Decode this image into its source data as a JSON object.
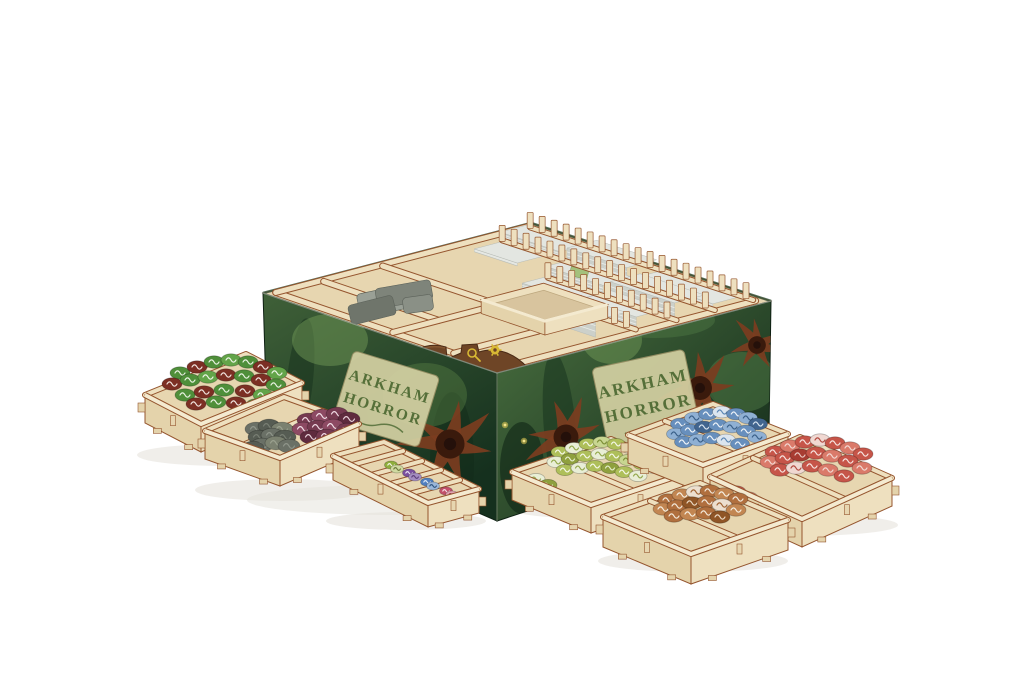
{
  "meta": {
    "alt": "Product photo of a wooden board game box organizer insert for Arkham Horror: an open game box with green tentacle cover art holding laser-cut plywood card racks full of cards, surrounded by seven small plywood trays filled with colored game tokens on a white background",
    "background": "#ffffff"
  },
  "logo": {
    "line1": "ARKHAM",
    "line2": "HORROR"
  },
  "colors": {
    "wood": "#eee0bf",
    "woodLight": "#f4ead0",
    "woodMid": "#e4d3ab",
    "woodFloor": "#e7d6b0",
    "woodShade": "#d6c096",
    "burn": "#95552e",
    "parchment": "#d3d0a2",
    "logoText": "#49662f",
    "tentacle": "#7c3d1f",
    "tentacleDark": "#3a1a0c",
    "card": "#ccd0ca",
    "cardLight": "#e3e6e1",
    "cardEdge": "#b8bcb6",
    "pieceBrown": "#6e4526",
    "pieceBrownDark": "#46260f",
    "glyphYellow": "#d8b934",
    "shadow": "#e6e3dc",
    "boxEdge": "#2c4a30"
  },
  "shadows": [
    [
      392,
      500,
      145,
      15
    ],
    [
      648,
      486,
      150,
      14
    ]
  ],
  "box": {
    "top": [
      [
        263,
        293
      ],
      [
        531,
        223
      ],
      [
        771,
        301
      ],
      [
        497,
        373
      ]
    ],
    "leftFace": "263,293 497,373 497,521 267,421",
    "rightFace": "497,373 771,301 769,432 497,521"
  },
  "innerWalls": [
    [
      0.03,
      0.02,
      0.03,
      0.97
    ],
    [
      0.03,
      0.97,
      0.97,
      0.97
    ],
    [
      0.03,
      0.02,
      0.97,
      0.02
    ],
    [
      0.2,
      0.03,
      0.2,
      0.52
    ],
    [
      0.42,
      0.03,
      0.42,
      0.52
    ],
    [
      0.03,
      0.52,
      0.42,
      0.52
    ],
    [
      0.03,
      0.78,
      0.34,
      0.78
    ]
  ],
  "cardRows": [
    {
      "a": 0.9,
      "segs": [
        [
          0.05,
          0.3,
          6
        ],
        [
          0.33,
          0.58,
          12
        ],
        [
          0.61,
          0.94,
          4
        ]
      ]
    },
    {
      "a": 0.76,
      "segs": [
        [
          0.1,
          0.28,
          3
        ],
        [
          0.4,
          0.64,
          9
        ],
        [
          0.67,
          0.94,
          15
        ]
      ]
    },
    {
      "a": 0.62,
      "segs": [
        [
          0.46,
          0.68,
          7
        ],
        [
          0.71,
          0.94,
          11
        ]
      ]
    },
    {
      "a": 0.48,
      "segs": [
        [
          0.6,
          0.93,
          17
        ]
      ]
    }
  ],
  "teethRows": [
    {
      "a": 0.97,
      "b1": 0.03,
      "b2": 0.96,
      "step": 0.05
    },
    {
      "a": 0.83,
      "b1": 0.07,
      "b2": 0.96,
      "step": 0.05
    },
    {
      "a": 0.69,
      "b1": 0.42,
      "b2": 0.96,
      "step": 0.05
    },
    {
      "a": 0.55,
      "b1": 0.56,
      "b2": 0.95,
      "step": 0.05
    }
  ],
  "greenCard": {
    "x": 579,
    "y": 273,
    "w": 18,
    "h": 9,
    "rot": 14,
    "fill": "#a4c17c"
  },
  "grayPieces": [
    [
      388,
      300,
      60,
      24,
      -12,
      "#9aa096"
    ],
    [
      404,
      294,
      56,
      20,
      -10,
      "#7e847a"
    ],
    [
      372,
      310,
      46,
      20,
      -14,
      "#6f756b"
    ],
    [
      418,
      304,
      30,
      16,
      -8,
      "#8a9086"
    ]
  ],
  "openBox": {
    "a1": 0.33,
    "b1": 0.55,
    "a2": 0.56,
    "b2": 0.82,
    "lift": 14
  },
  "frontPiece": {
    "shadow": "M402,394 C436,382 478,376 536,383 L536,396 L402,402 Z",
    "body": "M397,392 L397,371 C404,352 426,341 446,347 L447,359 L461,353 L462,345 L477,344 L479,352 C497,346 515,354 527,367 L541,385 L541,399 L469,408 L397,400 Z"
  },
  "blobs": [
    [
      "L",
      300,
      380,
      13,
      62,
      6,
      "#16301c",
      0.5
    ],
    [
      "L",
      352,
      442,
      15,
      68,
      4,
      "#1a3422",
      0.5
    ],
    [
      "L",
      452,
      462,
      22,
      70,
      0,
      "#122a19",
      0.45
    ],
    [
      "L",
      330,
      340,
      38,
      26,
      0,
      "#6f9756",
      0.5
    ],
    [
      "L",
      425,
      395,
      42,
      32,
      0,
      "#5d8547",
      0.4
    ],
    [
      "L",
      285,
      420,
      26,
      34,
      0,
      "#3f6439",
      0.5
    ],
    [
      "R",
      560,
      430,
      16,
      78,
      -5,
      "#14301c",
      0.5
    ],
    [
      "R",
      612,
      340,
      30,
      24,
      0,
      "#6f9756",
      0.5
    ],
    [
      "R",
      700,
      438,
      24,
      55,
      -4,
      "#173322",
      0.5
    ],
    [
      "R",
      742,
      382,
      36,
      30,
      0,
      "#548049",
      0.45
    ],
    [
      "R",
      522,
      468,
      22,
      46,
      0,
      "#0f2416",
      0.6
    ],
    [
      "R",
      655,
      320,
      60,
      18,
      0,
      "#4f7a45",
      0.45
    ]
  ],
  "starfish": [
    [
      "L",
      450,
      444,
      56,
      10
    ],
    [
      "L",
      302,
      434,
      34,
      40
    ],
    [
      "R",
      566,
      437,
      48,
      -20
    ],
    [
      "R",
      700,
      388,
      46,
      -5
    ],
    [
      "R",
      757,
      345,
      34,
      60
    ]
  ],
  "lights": [
    [
      524,
      441
    ],
    [
      536,
      469
    ],
    [
      316,
      446
    ],
    [
      505,
      425
    ]
  ],
  "trays": [
    {
      "name": "rune-tokens-tray",
      "rx": 10,
      "B": [
        246,
        354
      ],
      "R": [
        302,
        383
      ],
      "F": [
        201,
        424
      ],
      "L": [
        145,
        395
      ],
      "d": 28,
      "dividers": [],
      "palette": [
        "#4f8f3a",
        "#7c2f24",
        "#63a449",
        "#95402f"
      ],
      "marks": [
        "#e9f2e2",
        "#f0e3de",
        "#edf5e6",
        "#f0e3de"
      ],
      "tokens": [
        [
          180,
          373,
          0
        ],
        [
          197,
          367,
          1
        ],
        [
          214,
          362,
          0
        ],
        [
          231,
          360,
          2
        ],
        [
          248,
          362,
          0
        ],
        [
          263,
          367,
          1
        ],
        [
          277,
          373,
          2
        ],
        [
          172,
          384,
          1
        ],
        [
          190,
          380,
          0
        ],
        [
          208,
          377,
          2
        ],
        [
          226,
          375,
          1
        ],
        [
          244,
          376,
          0
        ],
        [
          261,
          380,
          1
        ],
        [
          276,
          385,
          0
        ],
        [
          185,
          395,
          0
        ],
        [
          204,
          392,
          1
        ],
        [
          224,
          390,
          0
        ],
        [
          245,
          391,
          1
        ],
        [
          263,
          395,
          2
        ],
        [
          279,
          398,
          1
        ],
        [
          196,
          404,
          1
        ],
        [
          216,
          402,
          0
        ],
        [
          236,
          403,
          1
        ],
        [
          256,
          405,
          0
        ]
      ],
      "shadow": [
        225,
        455,
        88,
        11
      ]
    },
    {
      "name": "coins-and-purple-tokens-tray",
      "rx": 11,
      "B": [
        284,
        397
      ],
      "R": [
        359,
        424
      ],
      "F": [
        280,
        458
      ],
      "L": [
        205,
        431
      ],
      "d": 28,
      "dividers": [
        [
          [
            245,
            444
          ],
          [
            323,
            411
          ]
        ]
      ],
      "palette": [
        "#6a7066",
        "#565c53",
        "#7b8170",
        "#763a50",
        "#8d4a63",
        "#5f2b3e"
      ],
      "marks": [
        "#8f958a",
        "#787e73",
        "#9aa08e",
        "#efd9e2",
        "#f2e0e8",
        "#e8d2da"
      ],
      "tokens": [
        [
          256,
          429,
          0
        ],
        [
          269,
          426,
          1
        ],
        [
          282,
          429,
          2
        ],
        [
          259,
          437,
          1
        ],
        [
          272,
          435,
          0
        ],
        [
          285,
          437,
          1
        ],
        [
          262,
          445,
          0
        ],
        [
          276,
          443,
          2
        ],
        [
          289,
          446,
          0
        ],
        [
          253,
          448,
          1
        ],
        [
          308,
          420,
          3
        ],
        [
          322,
          416,
          4
        ],
        [
          337,
          414,
          3
        ],
        [
          349,
          419,
          5
        ],
        [
          303,
          429,
          4
        ],
        [
          318,
          427,
          3
        ],
        [
          333,
          426,
          4
        ],
        [
          347,
          430,
          3
        ],
        [
          311,
          437,
          5
        ],
        [
          327,
          436,
          3
        ],
        [
          342,
          439,
          4
        ]
      ],
      "shadow": [
        283,
        490,
        88,
        11
      ]
    },
    {
      "name": "small-tokens-strip-tray",
      "rx": 6.5,
      "B": [
        384,
        442
      ],
      "R": [
        479,
        489
      ],
      "F": [
        428,
        503
      ],
      "L": [
        333,
        456
      ],
      "d": 24,
      "dividers": [
        [
          [
            403,
            451
          ],
          [
            352,
            465
          ]
        ],
        [
          [
            422,
            461
          ],
          [
            371,
            475
          ]
        ],
        [
          [
            441,
            470
          ],
          [
            390,
            484
          ]
        ],
        [
          [
            460,
            480
          ],
          [
            409,
            494
          ]
        ]
      ],
      "palette": [
        "#8fae3c",
        "#cfd9a0",
        "#7a4e9e",
        "#a48cc0",
        "#4f7ec0",
        "#9ab6d8",
        "#c2506a",
        "#e0a2b0"
      ],
      "marks": [
        "#f2f6e4",
        "#6b7a3a",
        "#e8e0f2",
        "#5d3f7a",
        "#dce8f4",
        "#2f5580",
        "#f4dde4",
        "#8f3248"
      ],
      "tokens": [
        [
          391,
          465,
          0
        ],
        [
          397,
          469,
          1
        ],
        [
          409,
          473,
          2
        ],
        [
          415,
          477,
          3
        ],
        [
          427,
          482,
          4
        ],
        [
          433,
          486,
          5
        ],
        [
          446,
          491,
          6
        ],
        [
          452,
          495,
          7
        ]
      ],
      "shadow": [
        406,
        521,
        80,
        9
      ]
    },
    {
      "name": "lime-tokens-tray",
      "rx": 9,
      "B": [
        611,
        439
      ],
      "R": [
        690,
        472
      ],
      "F": [
        591,
        505
      ],
      "L": [
        512,
        472
      ],
      "d": 28,
      "dividers": [
        [
          [
            555,
            458
          ],
          [
            634,
            491
          ]
        ]
      ],
      "palette": [
        "#aebf5a",
        "#e9eed6",
        "#8fa03e",
        "#c8d690"
      ],
      "marks": [
        "#f4f7e8",
        "#93a84c",
        "#e3ecc8",
        "#7c8f36"
      ],
      "tokens": [
        [
          560,
          452,
          0
        ],
        [
          574,
          448,
          1
        ],
        [
          588,
          444,
          0
        ],
        [
          602,
          442,
          3
        ],
        [
          616,
          444,
          0
        ],
        [
          630,
          448,
          1
        ],
        [
          644,
          452,
          0
        ],
        [
          656,
          457,
          2
        ],
        [
          556,
          462,
          1
        ],
        [
          570,
          459,
          2
        ],
        [
          585,
          456,
          0
        ],
        [
          600,
          454,
          1
        ],
        [
          614,
          456,
          0
        ],
        [
          628,
          460,
          3
        ],
        [
          642,
          464,
          0
        ],
        [
          654,
          468,
          1
        ],
        [
          565,
          470,
          0
        ],
        [
          580,
          468,
          1
        ],
        [
          595,
          466,
          0
        ],
        [
          610,
          468,
          2
        ],
        [
          624,
          472,
          0
        ],
        [
          638,
          476,
          1
        ],
        [
          524,
          481,
          0
        ],
        [
          536,
          479,
          1
        ],
        [
          548,
          485,
          2
        ]
      ],
      "shadow": [
        600,
        508,
        92,
        11
      ]
    },
    {
      "name": "blue-tokens-tray",
      "rx": 9.5,
      "B": [
        713,
        404
      ],
      "R": [
        788,
        434
      ],
      "F": [
        703,
        465
      ],
      "L": [
        628,
        435
      ],
      "d": 28,
      "dividers": [
        [
          [
            665,
            421
          ],
          [
            740,
            451
          ]
        ]
      ],
      "palette": [
        "#678fbd",
        "#8fb0d4",
        "#dbe5ef",
        "#41658f"
      ],
      "marks": [
        "#eef3f8",
        "#3a5f88",
        "#5c87b4",
        "#d7e3ef"
      ],
      "tokens": [
        [
          680,
          424,
          0
        ],
        [
          694,
          418,
          1
        ],
        [
          708,
          414,
          0
        ],
        [
          722,
          412,
          2
        ],
        [
          736,
          414,
          0
        ],
        [
          748,
          418,
          1
        ],
        [
          758,
          424,
          3
        ],
        [
          676,
          434,
          1
        ],
        [
          690,
          430,
          0
        ],
        [
          704,
          427,
          3
        ],
        [
          718,
          425,
          0
        ],
        [
          732,
          427,
          1
        ],
        [
          746,
          431,
          0
        ],
        [
          757,
          437,
          1
        ],
        [
          684,
          442,
          0
        ],
        [
          698,
          440,
          1
        ],
        [
          712,
          438,
          0
        ],
        [
          726,
          440,
          2
        ],
        [
          740,
          444,
          0
        ],
        [
          654,
          452,
          1
        ],
        [
          666,
          456,
          0
        ]
      ],
      "shadow": [
        706,
        469,
        90,
        11
      ]
    },
    {
      "name": "red-tokens-tray",
      "rx": 10,
      "B": [
        800,
        437
      ],
      "R": [
        892,
        478
      ],
      "F": [
        802,
        519
      ],
      "L": [
        710,
        477
      ],
      "d": 28,
      "dividers": [
        [
          [
            753,
            458
          ],
          [
            845,
            499
          ]
        ]
      ],
      "palette": [
        "#c65549",
        "#da7a6a",
        "#f0d8d2",
        "#a83c32"
      ],
      "marks": [
        "#f6e4e0",
        "#f2d8d2",
        "#b24a40",
        "#e8c6c0"
      ],
      "tokens": [
        [
          775,
          452,
          0
        ],
        [
          790,
          446,
          1
        ],
        [
          805,
          442,
          0
        ],
        [
          820,
          440,
          2
        ],
        [
          835,
          443,
          0
        ],
        [
          850,
          448,
          1
        ],
        [
          863,
          454,
          0
        ],
        [
          770,
          462,
          1
        ],
        [
          785,
          458,
          0
        ],
        [
          800,
          455,
          3
        ],
        [
          816,
          453,
          0
        ],
        [
          832,
          456,
          1
        ],
        [
          848,
          461,
          0
        ],
        [
          862,
          468,
          1
        ],
        [
          780,
          470,
          0
        ],
        [
          796,
          468,
          2
        ],
        [
          812,
          466,
          0
        ],
        [
          828,
          470,
          1
        ],
        [
          844,
          476,
          0
        ],
        [
          736,
          492,
          0
        ],
        [
          748,
          498,
          1
        ],
        [
          758,
          504,
          0
        ]
      ],
      "shadow": [
        800,
        525,
        98,
        11
      ]
    },
    {
      "name": "brown-tokens-tray",
      "rx": 10,
      "B": [
        700,
        483
      ],
      "R": [
        788,
        520
      ],
      "F": [
        691,
        554
      ],
      "L": [
        603,
        517
      ],
      "d": 30,
      "dividers": [
        [
          [
            650,
            501
          ],
          [
            738,
            538
          ]
        ]
      ],
      "palette": [
        "#b06f3e",
        "#c28652",
        "#ecdfcf",
        "#8f5526"
      ],
      "marks": [
        "#f2e8da",
        "#f6efe2",
        "#a06434",
        "#ead8c2"
      ],
      "tokens": [
        [
          668,
          500,
          0
        ],
        [
          682,
          495,
          1
        ],
        [
          696,
          492,
          2
        ],
        [
          710,
          491,
          0
        ],
        [
          724,
          494,
          1
        ],
        [
          738,
          499,
          0
        ],
        [
          663,
          509,
          1
        ],
        [
          677,
          506,
          0
        ],
        [
          692,
          503,
          3
        ],
        [
          707,
          502,
          0
        ],
        [
          722,
          505,
          2
        ],
        [
          736,
          510,
          1
        ],
        [
          674,
          516,
          0
        ],
        [
          690,
          514,
          1
        ],
        [
          706,
          513,
          0
        ],
        [
          720,
          517,
          3
        ]
      ],
      "shadow": [
        693,
        561,
        95,
        11
      ]
    }
  ]
}
